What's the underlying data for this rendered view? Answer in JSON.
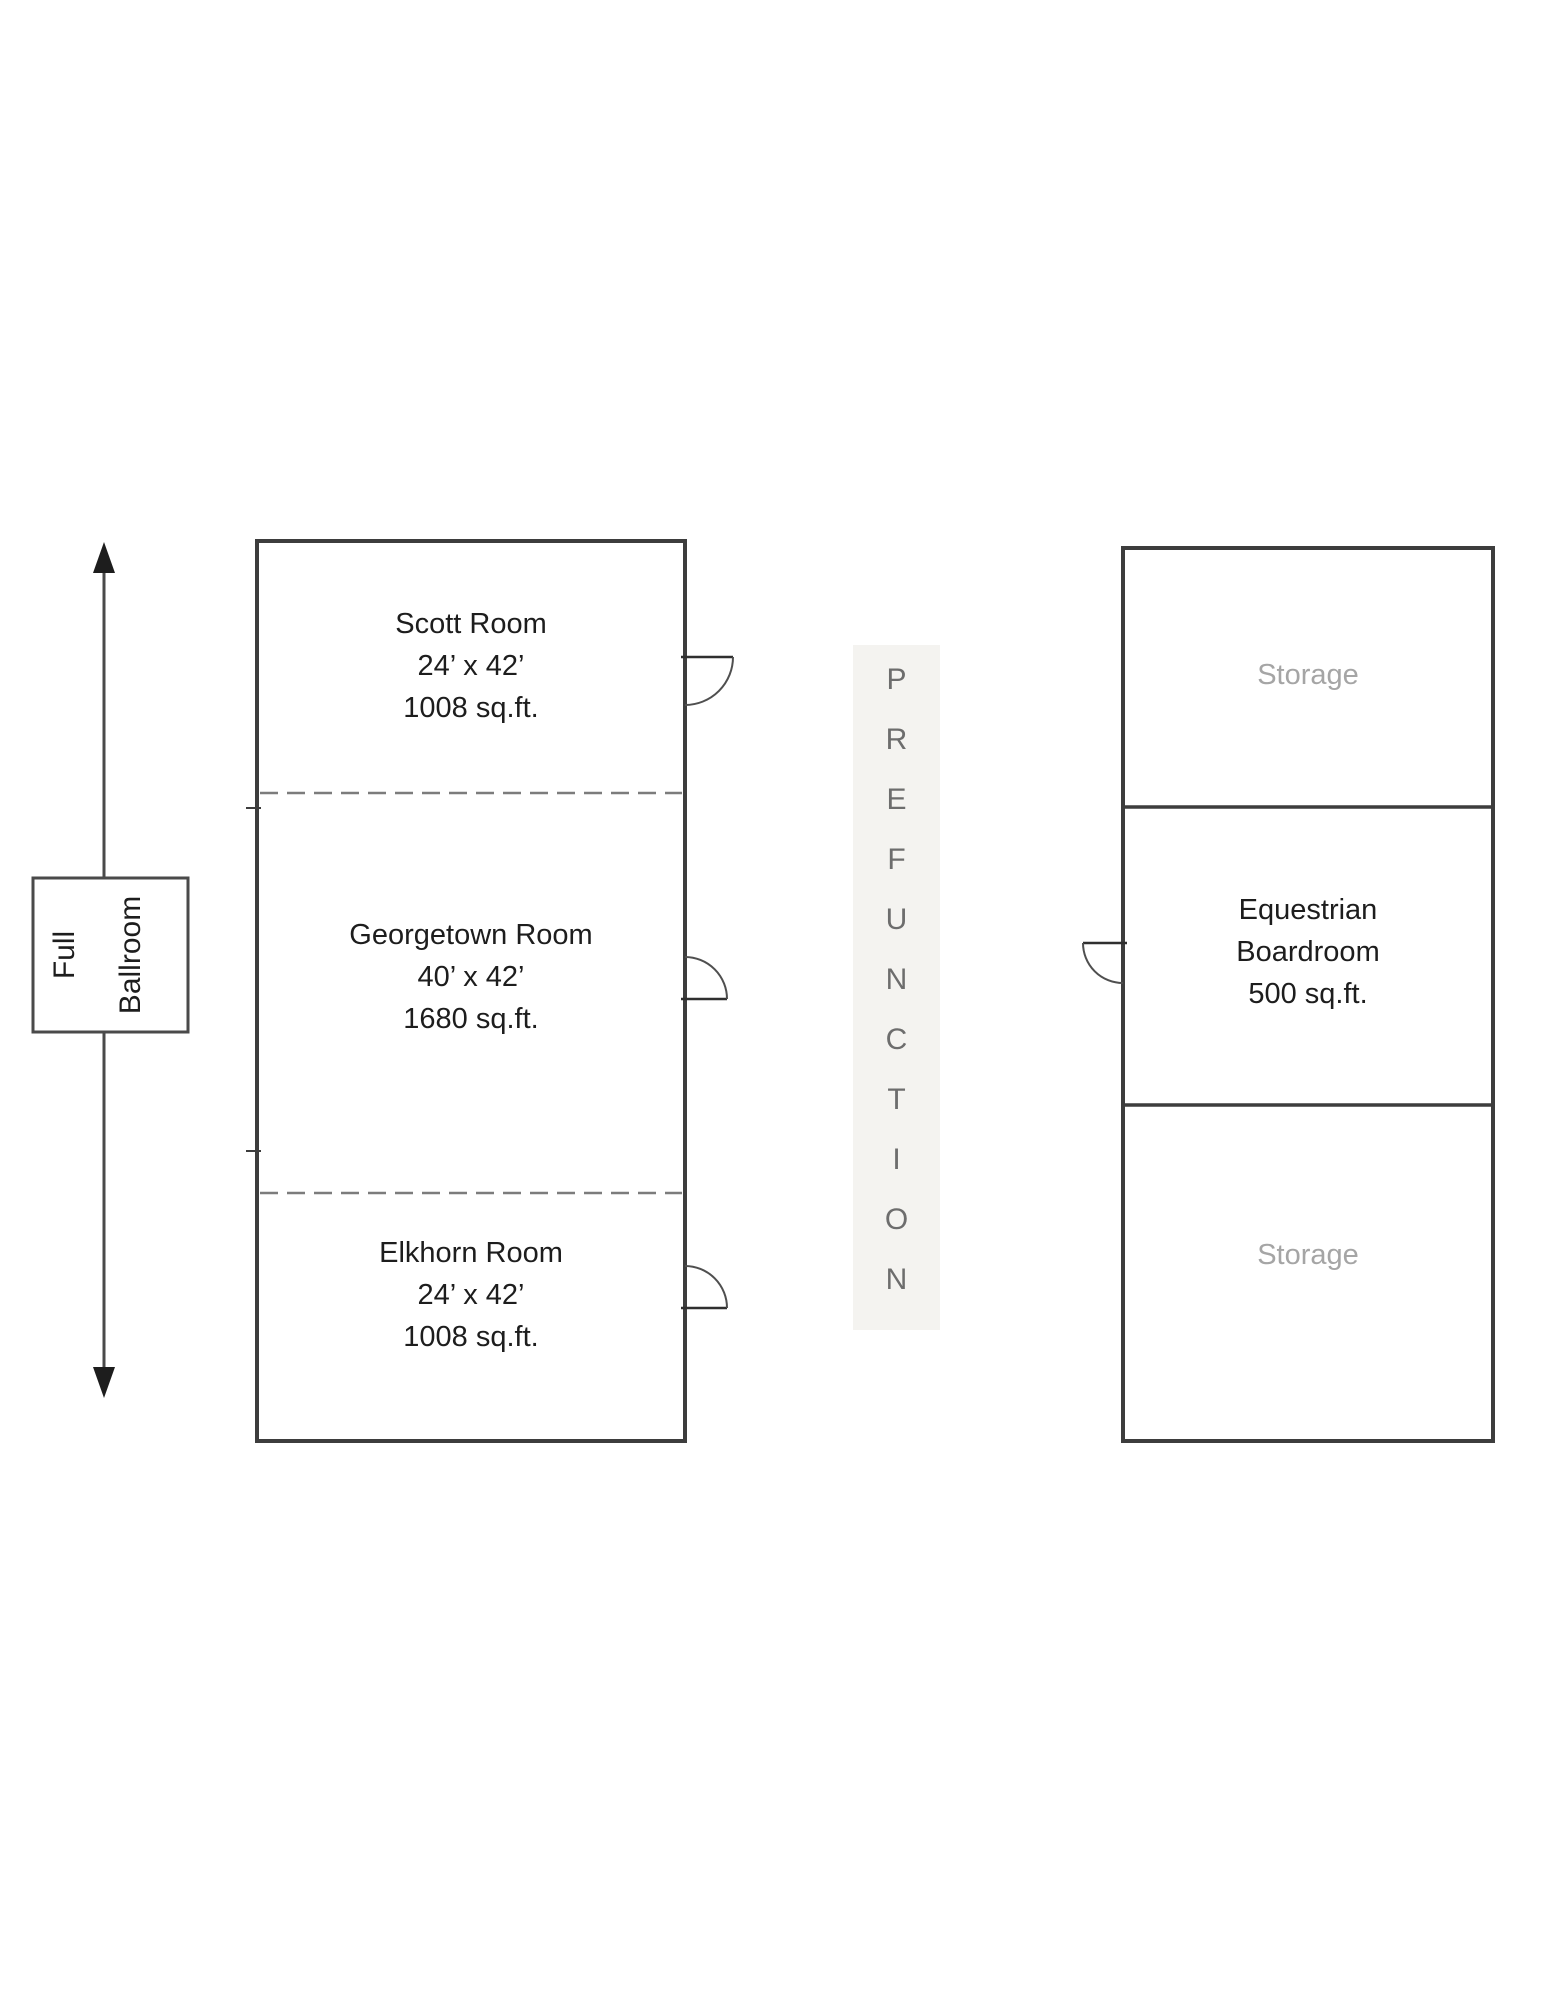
{
  "colors": {
    "background": "#ffffff",
    "wall": "#3d3d3d",
    "dashed_divider": "#7c7c7c",
    "door": "#4f4f4f",
    "room_text": "#1d1d1d",
    "storage_text": "#a5a5a5",
    "prefunction_text": "#6d6d6d",
    "prefunction_strip": "#f4f3f0"
  },
  "full_ballroom_label": {
    "line1": "Full",
    "line2": "Ballroom"
  },
  "ballroom_sections": [
    {
      "name": "Scott Room",
      "dimensions": "24’ x 42’",
      "area": "1008 sq.ft."
    },
    {
      "name": "Georgetown Room",
      "dimensions": "40’ x 42’",
      "area": "1680 sq.ft."
    },
    {
      "name": "Elkhorn Room",
      "dimensions": "24’ x 42’",
      "area": "1008 sq.ft."
    }
  ],
  "prefunction": {
    "label": "PREFUNCTION"
  },
  "right_wing": {
    "storage_top": {
      "name": "Storage"
    },
    "equestrian_boardroom": {
      "line1": "Equestrian",
      "line2": "Boardroom",
      "area": "500 sq.ft."
    },
    "storage_bottom": {
      "name": "Storage"
    }
  }
}
